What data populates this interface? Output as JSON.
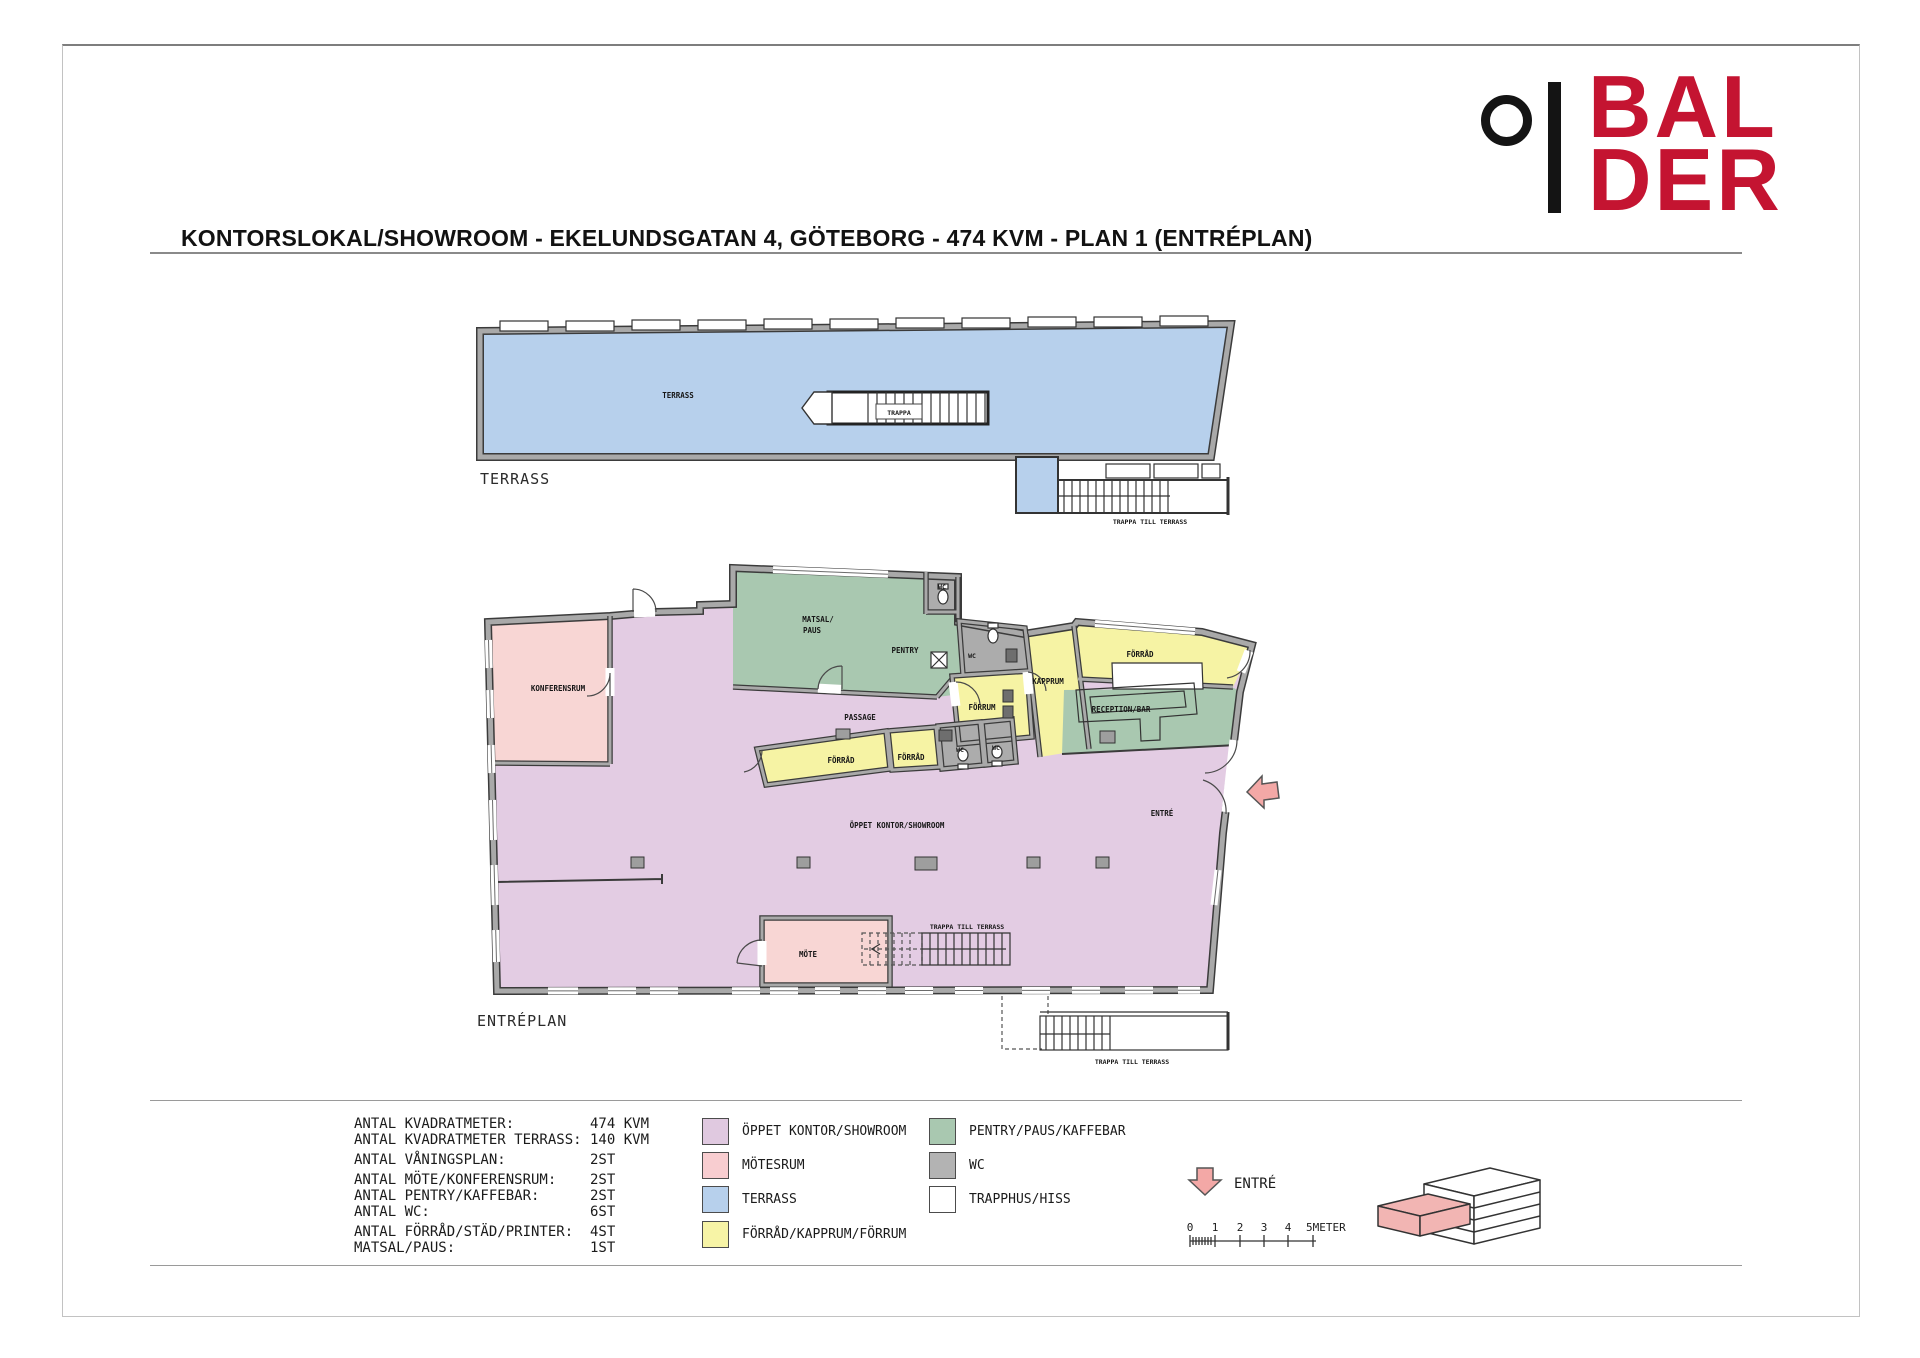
{
  "header": {
    "title": "KONTORSLOKAL/SHOWROOM - EKELUNDSGATAN 4, GÖTEBORG - 474 KVM - PLAN 1 (ENTRÉPLAN)",
    "logo": {
      "line1": "BAL",
      "line2": "DER"
    }
  },
  "plans": {
    "terrace": {
      "caption": "TERRASS",
      "room": "TERRASS",
      "stair": "TRAPPA",
      "stair_caption": "TRAPPA TILL TERRASS"
    },
    "entrance": {
      "caption": "ENTRÉPLAN",
      "rooms": {
        "konferensrum": "KONFERENSRUM",
        "matsal_line1": "MATSAL/",
        "matsal_line2": "PAUS",
        "pentry": "PENTRY",
        "wc": "WC",
        "forrum": "FÖRRUM",
        "kapprum": "KAPPRUM",
        "forrad": "FÖRRÅD",
        "reception": "RECEPTION/BAR",
        "passage": "PASSAGE",
        "oppet": "ÖPPET KONTOR/SHOWROOM",
        "entre": "ENTRÉ",
        "mote": "MÖTE",
        "stair_caption": "TRAPPA TILL TERRASS"
      }
    }
  },
  "footer": {
    "stats": [
      {
        "label": "ANTAL KVADRATMETER:",
        "value": "474 KVM"
      },
      {
        "label": "ANTAL KVADRATMETER TERRASS:",
        "value": "140 KVM"
      },
      {
        "label": "ANTAL VÅNINGSPLAN:",
        "value": "2ST"
      },
      {
        "label": "ANTAL MÖTE/KONFERENSRUM:",
        "value": "2ST"
      },
      {
        "label": "ANTAL PENTRY/KAFFEBAR:",
        "value": "2ST"
      },
      {
        "label": "ANTAL WC:",
        "value": "6ST"
      },
      {
        "label": "ANTAL FÖRRÅD/STÄD/PRINTER:",
        "value": "4ST"
      },
      {
        "label": "MATSAL/PAUS:",
        "value": "1ST"
      }
    ],
    "legend_col1": [
      {
        "label": "ÖPPET KONTOR/SHOWROOM",
        "color": "#e0c9e0"
      },
      {
        "label": "MÖTESRUM",
        "color": "#f8cdd0"
      },
      {
        "label": "TERRASS",
        "color": "#b7d0ec"
      },
      {
        "label": "FÖRRÅD/KAPPRUM/FÖRRUM",
        "color": "#f7f4a6"
      }
    ],
    "legend_col2": [
      {
        "label": "PENTRY/PAUS/KAFFEBAR",
        "color": "#a9c8b0"
      },
      {
        "label": "WC",
        "color": "#b3b3b3"
      },
      {
        "label": "TRAPPHUS/HISS",
        "color": "#ffffff"
      }
    ],
    "entry": {
      "label": "ENTRÉ"
    },
    "scale": {
      "t0": "0",
      "t1": "1",
      "t2": "2",
      "t3": "3",
      "t4": "4",
      "end": "5METER"
    }
  },
  "colors": {
    "brand_red": "#c41431",
    "open_office": "#e3cce3",
    "meeting": "#f8d6d4",
    "terrace": "#b7d0ec",
    "storage": "#f6f3a4",
    "pantry": "#a9c8b0",
    "wc": "#acacac",
    "wall": "#3b3b3b",
    "entry_arrow": "#f3a8a6"
  }
}
